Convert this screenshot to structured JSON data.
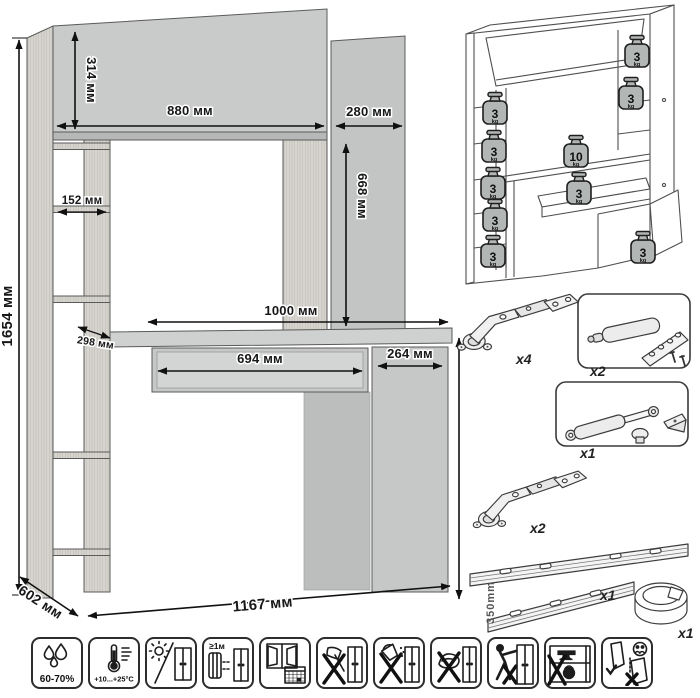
{
  "drawing": {
    "dims": {
      "total_height": "1654 мм",
      "hutch_section_height": "314 мм",
      "hutch_width": "880 мм",
      "top_cabinet_width": "280 мм",
      "top_cabinet_height": "668 мм",
      "shelf_width": "152 мм",
      "shelf_depth": "298 мм",
      "desktop_width": "1000 мм",
      "drawer_width": "694 мм",
      "pedestal_width": "264 мм",
      "desk_height": "746 мм",
      "depth": "602 мм",
      "total_width": "1167 мм"
    }
  },
  "load_schematic": {
    "weights": [
      {
        "v": "3",
        "u": "kg"
      },
      {
        "v": "3",
        "u": "kg"
      },
      {
        "v": "3",
        "u": "kg"
      },
      {
        "v": "3",
        "u": "kg"
      },
      {
        "v": "3",
        "u": "kg"
      },
      {
        "v": "3",
        "u": "kg"
      },
      {
        "v": "3",
        "u": "kg"
      },
      {
        "v": "10",
        "u": "kg"
      },
      {
        "v": "3",
        "u": "kg"
      },
      {
        "v": "3",
        "u": "kg"
      }
    ]
  },
  "hardware": {
    "items": [
      {
        "name": "concealed-hinge",
        "qty": "x4"
      },
      {
        "name": "door-damper",
        "qty": "x2"
      },
      {
        "name": "gas-lift",
        "qty": "x1"
      },
      {
        "name": "concealed-hinge",
        "qty": "x2"
      },
      {
        "name": "drawer-slides",
        "qty": "x1",
        "length": "350mm"
      },
      {
        "name": "cable-grommet",
        "qty": "x1"
      }
    ]
  },
  "care_icons": [
    {
      "name": "humidity-range",
      "label": "60-70%"
    },
    {
      "name": "temperature-range",
      "label": "+10...+25°C"
    },
    {
      "name": "avoid-direct-sunlight",
      "label": ""
    },
    {
      "name": "keep-distance-from-heaters",
      "label": "≥1м"
    },
    {
      "name": "ventilate-room",
      "label": ""
    },
    {
      "name": "no-sharp-objects",
      "label": ""
    },
    {
      "name": "no-spilling-liquids",
      "label": ""
    },
    {
      "name": "no-wet-abrasive-cleaning",
      "label": ""
    },
    {
      "name": "no-leaning-pushing",
      "label": ""
    },
    {
      "name": "no-heavy-overload",
      "label": ""
    },
    {
      "name": "carry-do-not-drag",
      "label": ""
    }
  ]
}
